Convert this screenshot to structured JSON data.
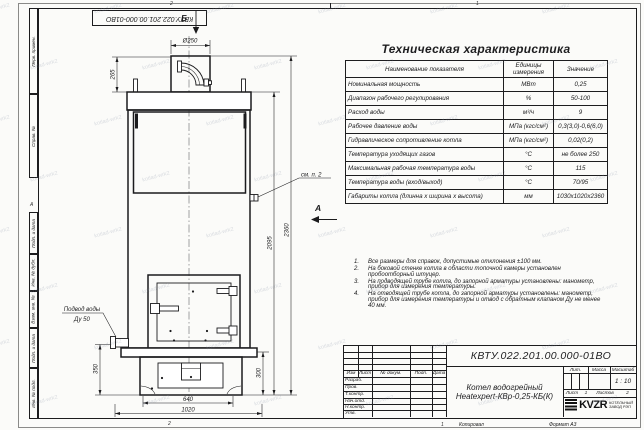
{
  "watermark": {
    "text": "kotlad-wrk2"
  },
  "frame": {
    "zone_top_left": "2",
    "zone_top_right": "1",
    "zone_bottom_left": "2",
    "zone_bottom_right": "1",
    "left_zone_marker": "А"
  },
  "side_stamps": {
    "fields": [
      "Перв. примен.",
      "Справ. №",
      "Подп. и дата",
      "Инв. № дубл.",
      "Взам. инв. №",
      "Подп. и дата",
      "Инв. № подл."
    ]
  },
  "drawing": {
    "view_b_label": "Б",
    "view_a_label": "А",
    "dim_chimney_dia": "Ø250",
    "dim_chimney_h": "265",
    "dim_body_h": "2095",
    "dim_total_h": "2360",
    "dim_inlet_h": "350",
    "dim_base_h": "300",
    "dim_opening_w": "640",
    "dim_total_w": "1020",
    "callout_note2": "см. п. 2",
    "water_supply_line1": "Подвод воды",
    "water_supply_line2": "Ду 50"
  },
  "spec_table": {
    "title": "Техническая характеристика",
    "headers": [
      "Наименование показателя",
      "Единицы измерения",
      "Значение"
    ],
    "rows": [
      [
        "Номинальная мощность",
        "МВт",
        "0,25"
      ],
      [
        "Диапазон рабочего регулирования",
        "%",
        "50-100"
      ],
      [
        "Расход воды",
        "м³/ч",
        "9"
      ],
      [
        "Рабочее давление воды",
        "МПа (кгс/см²)",
        "0,3(3,0)-0,6(6,0)"
      ],
      [
        "Гидравлическое сопротивление котла",
        "МПа (кгс/см²)",
        "0,02(0,2)"
      ],
      [
        "Температура уходящих газов",
        "°С",
        "не более 250"
      ],
      [
        "Максимальная рабочая температура воды",
        "°С",
        "115"
      ],
      [
        "Температура воды (вход/выход)",
        "°С",
        "70/95"
      ],
      [
        "Габариты котла (длинна х ширина х высота)",
        "мм",
        "1030х1020х2360"
      ]
    ]
  },
  "notes": [
    {
      "n": "1.",
      "t": "Все размеры для справок, допустимые отклонения ±100 мм."
    },
    {
      "n": "2.",
      "t": "На боковой стенке котла в области топочной камеры установлен пробоотборный штуцер."
    },
    {
      "n": "3.",
      "t": "На подводящей трубе котла, до запорной арматуры установлены: манометр, прибор для измерения температуры."
    },
    {
      "n": "4.",
      "t": "На отводящей трубе котла, до запорной арматуры установлены: манометр, прибор для измерения температуры и отвод с обратным клапаном Ду не менее 40 мм."
    }
  ],
  "title_block": {
    "doc_number": "КВТУ.022.201.00.000-01ВО",
    "name_line1": "Котел водогрейный",
    "name_line2": "Heatexpert-КВр-0,25-КБ(К)",
    "rev_headers": [
      "Изм",
      "Лист",
      "№ докум.",
      "Подп.",
      "Дата"
    ],
    "staff_rows": [
      "Разраб.",
      "Пров.",
      "Т.контр.",
      "Нач.отд.",
      "Н.контр.",
      "Утв."
    ],
    "lit_label": "Лит.",
    "mass_label": "Масса",
    "scale_label": "Масштаб",
    "scale_value": "1 : 10",
    "sheet_label": "Лист",
    "sheet_value": "1",
    "sheets_label": "Листов",
    "sheets_value": "2",
    "company_logo": "KVZR",
    "company_line1": "КОТЕЛЬНЫЙ",
    "company_line2": "ЗАВОД РЭП",
    "copied_label": "Копировал",
    "format_label": "Формат А3"
  }
}
